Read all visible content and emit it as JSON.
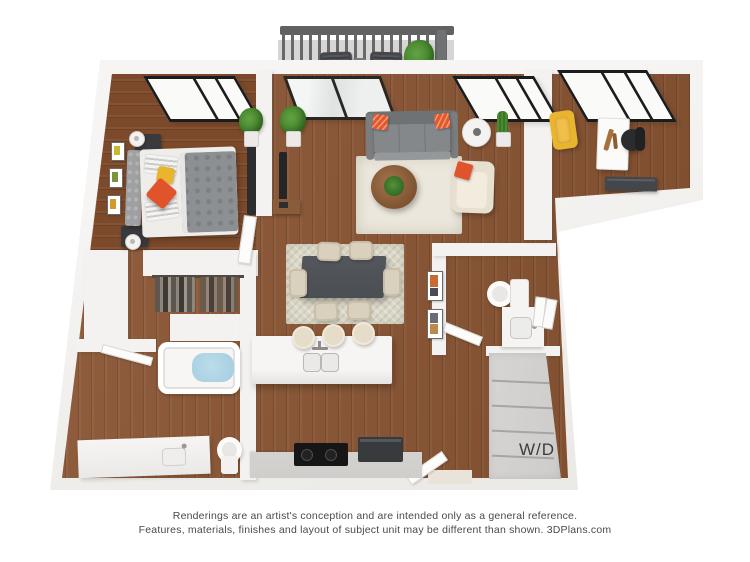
{
  "floorplan": {
    "washer_dryer_label": "W/D"
  },
  "disclaimer": {
    "line1": "Renderings are an artist's conception and are intended only as a general reference.",
    "line2": "Features, materials, finishes and layout of subject unit may be different than shown. 3DPlans.com"
  },
  "colors": {
    "wall": "#f3f2f0",
    "wood": "#8a5431",
    "wood-dark": "#7c4a2a",
    "area-rug": "#ebe7dc",
    "dining-rug": "#dcd9c9",
    "sofa-gray": "#84888b",
    "accent-orange": "#e0532b",
    "accent-yellow": "#e9b52e",
    "dining-table": "#4b4f54",
    "counter-gray": "#cfcecb",
    "wd-cabinet": "#cdccca",
    "tub-water": "#a3cde0",
    "plant-green": "#47852f",
    "railing-gray": "#5f6163",
    "window-frame": "#1c1c1c",
    "disclaimer-text": "#4a4a4a"
  }
}
